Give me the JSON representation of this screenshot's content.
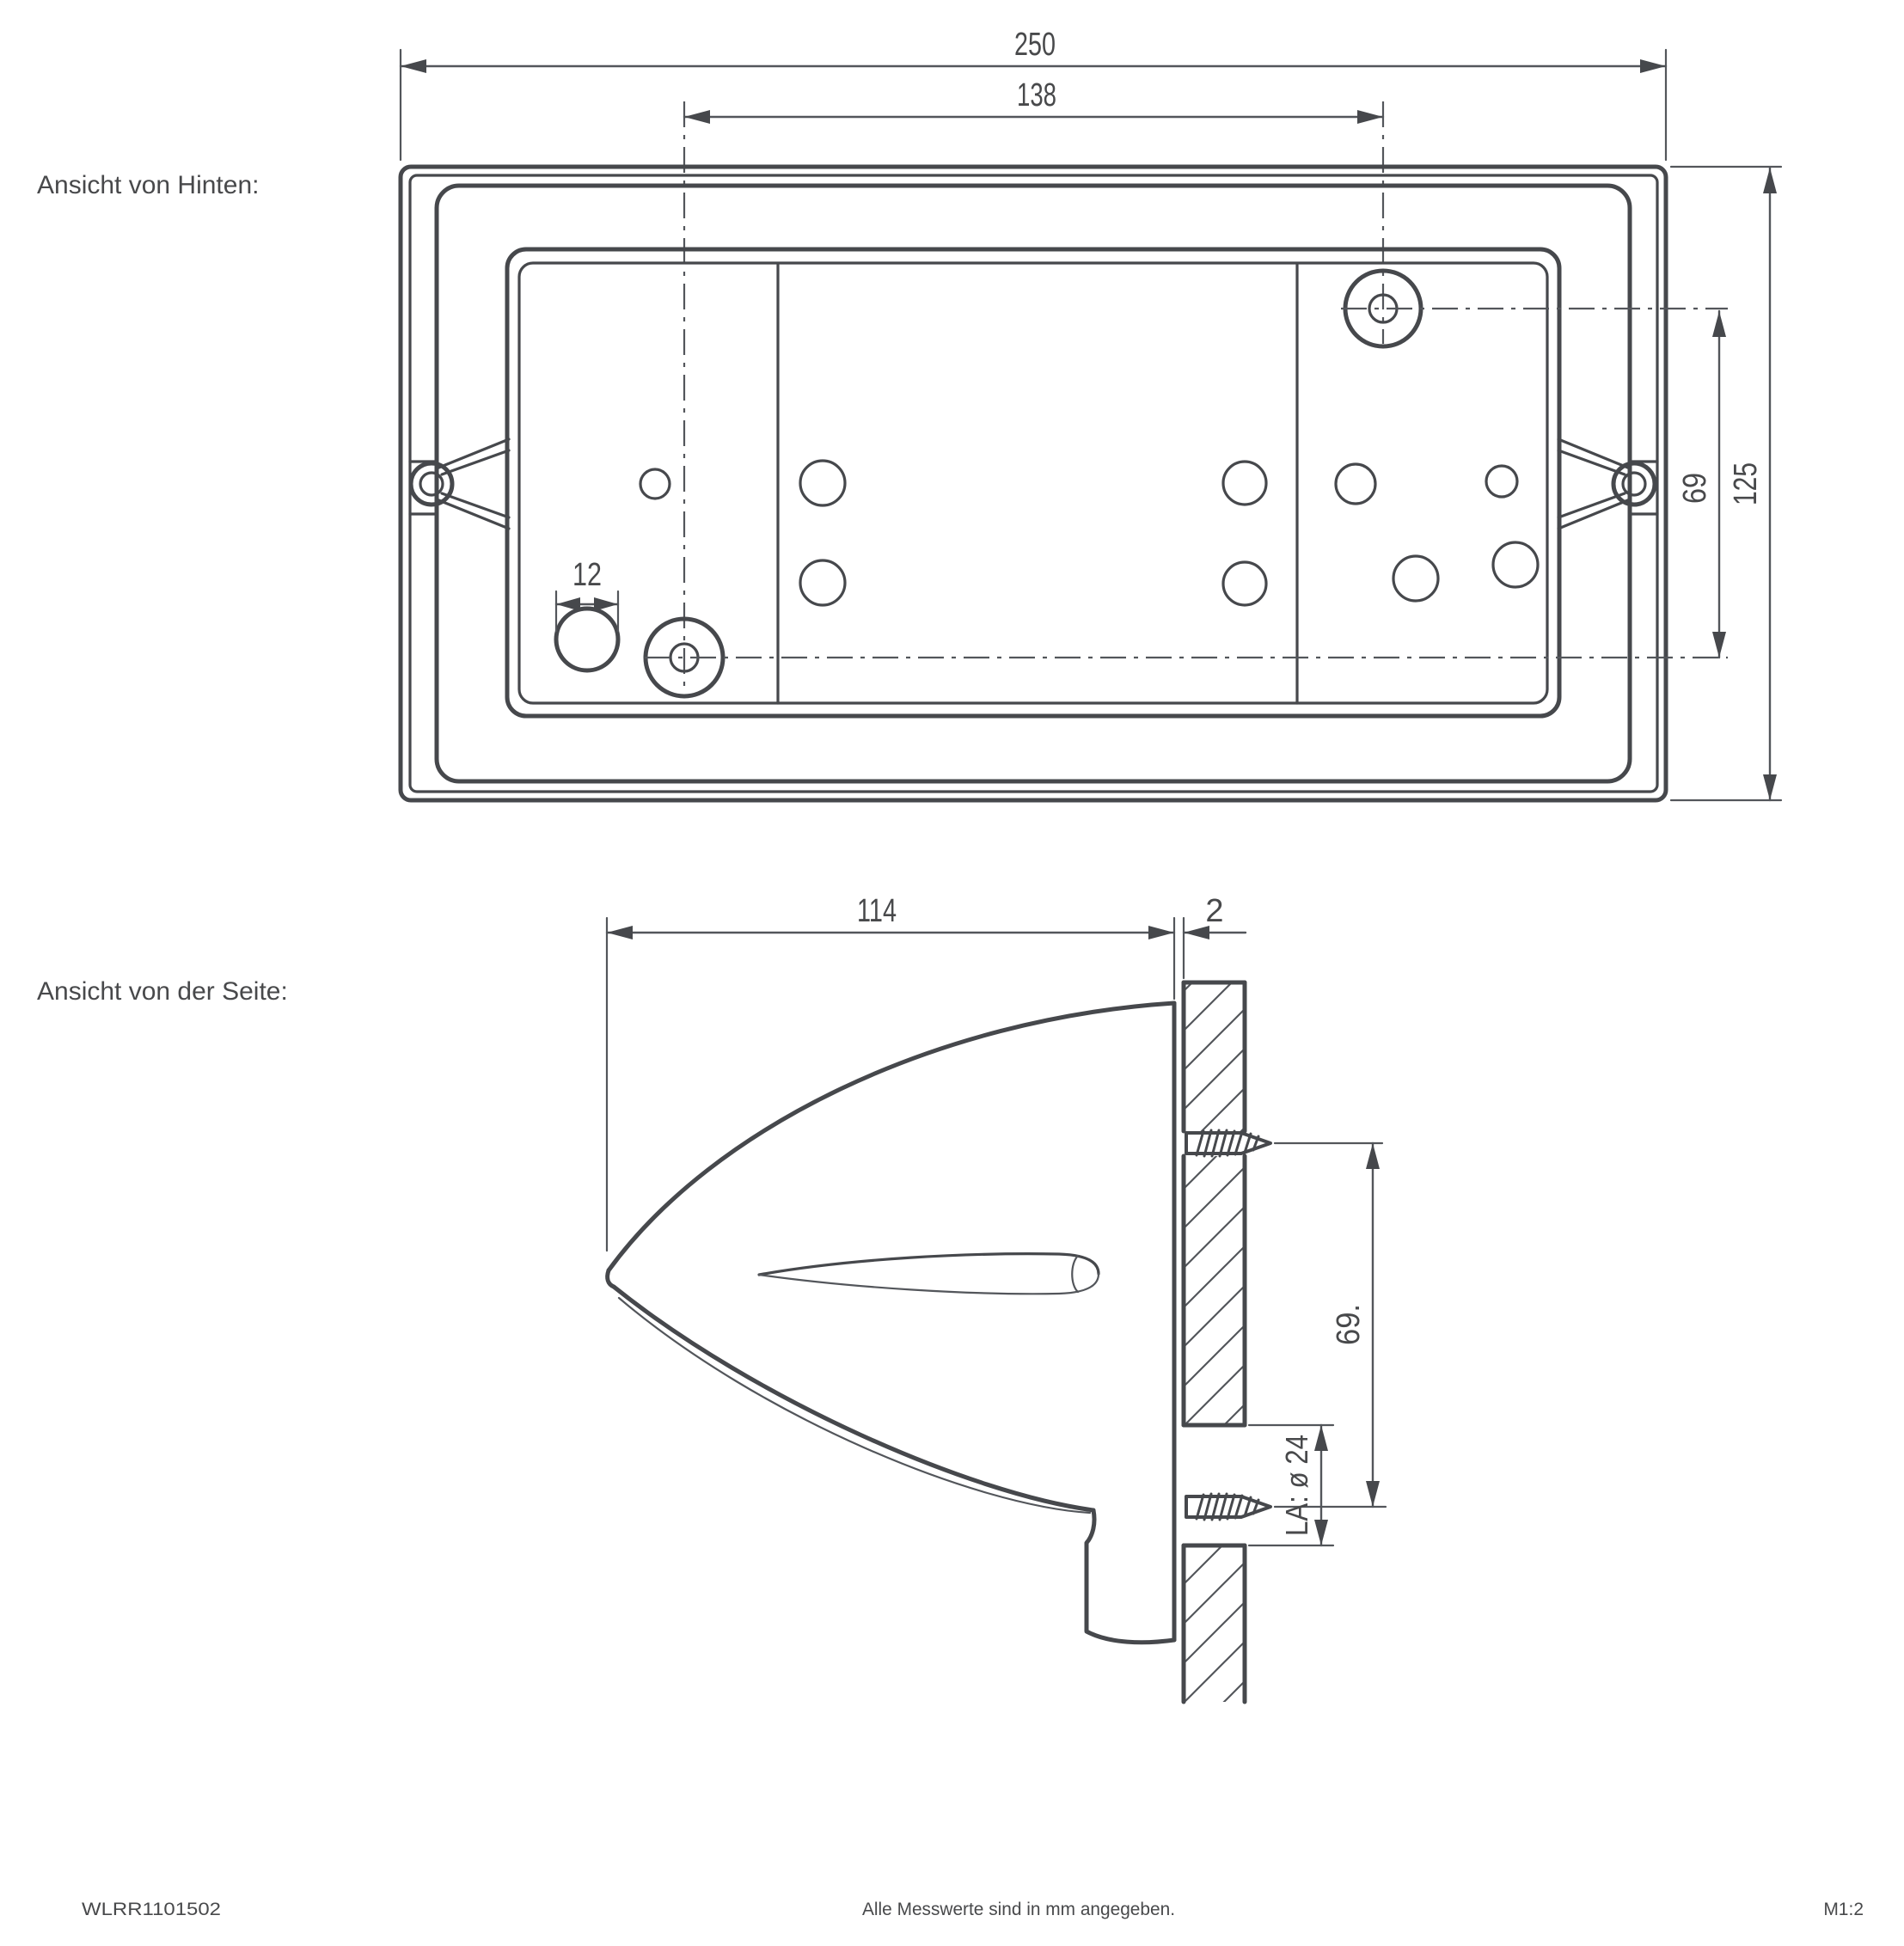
{
  "drawing": {
    "back_view": {
      "label": "Ansicht von Hinten:",
      "dim_total_width": "250",
      "dim_keyhole_spacing_h": "138",
      "dim_cable_hole": "12",
      "dim_keyhole_spacing_v": "69",
      "dim_total_height": "125"
    },
    "side_view": {
      "label": "Ansicht von der Seite:",
      "dim_depth": "114",
      "dim_wall_gap": "2",
      "dim_screw_spacing": "69.",
      "dim_wall_cutout": "LA: ø 24"
    },
    "footer": {
      "part_number": "WLRR1101502",
      "note": "Alle Messwerte sind in mm angegeben.",
      "scale": "M1:2"
    },
    "colors": {
      "line": "#46484c",
      "text": "#48494b",
      "background": "#ffffff"
    }
  }
}
